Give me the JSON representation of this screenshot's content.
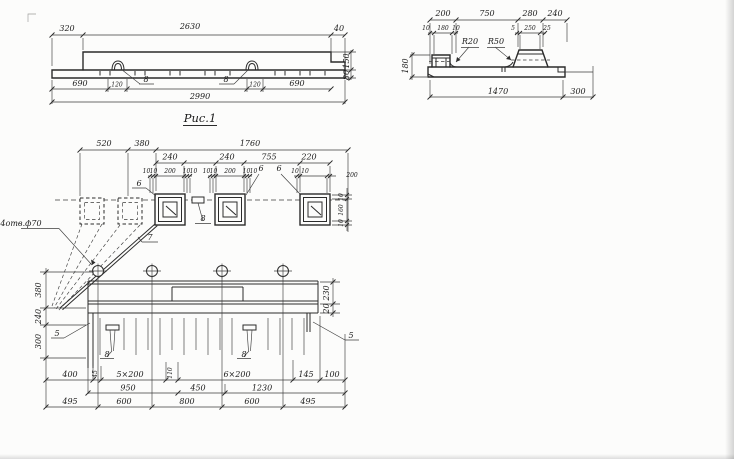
{
  "fig1": {
    "caption": "Рис.1",
    "top": [
      "320",
      "2630",
      "40"
    ],
    "bottom": [
      "690",
      "120",
      "120",
      "690"
    ],
    "callouts": [
      "8",
      "8"
    ],
    "total": "2990",
    "side": [
      "150",
      "80"
    ]
  },
  "fig2": {
    "top": [
      "200",
      "750",
      "280",
      "240"
    ],
    "sub": [
      "10",
      "180",
      "10",
      "5",
      "250",
      "25"
    ],
    "radii": [
      "R20",
      "R50"
    ],
    "side": "180",
    "bottom": [
      "1470",
      "300"
    ]
  },
  "fig3": {
    "top": [
      "520",
      "380",
      "1760"
    ],
    "row2": [
      "240",
      "240",
      "755",
      "220"
    ],
    "small1": [
      "10",
      "10",
      "200",
      "10",
      "10"
    ],
    "small2": [
      "10",
      "10",
      "200",
      "10",
      "10"
    ],
    "small3": [
      "10",
      "10",
      "200"
    ],
    "side_sq": [
      "10",
      "160",
      "10"
    ],
    "pos6": [
      "6",
      "6",
      "6"
    ],
    "pos7": "7",
    "pos8_plan": "8",
    "note": "4отв.ф70",
    "side_left": [
      "380",
      "240",
      "300"
    ],
    "side_right": [
      "230",
      "20"
    ],
    "pos5": [
      "5",
      "5"
    ],
    "pos8_elev": [
      "8",
      "8"
    ],
    "rowA": [
      "400",
      "45",
      "5×200",
      "110",
      "6×200",
      "145",
      "100"
    ],
    "rowB": [
      "950",
      "450",
      "1230"
    ],
    "rowC": [
      "495",
      "600",
      "800",
      "600",
      "495"
    ]
  }
}
